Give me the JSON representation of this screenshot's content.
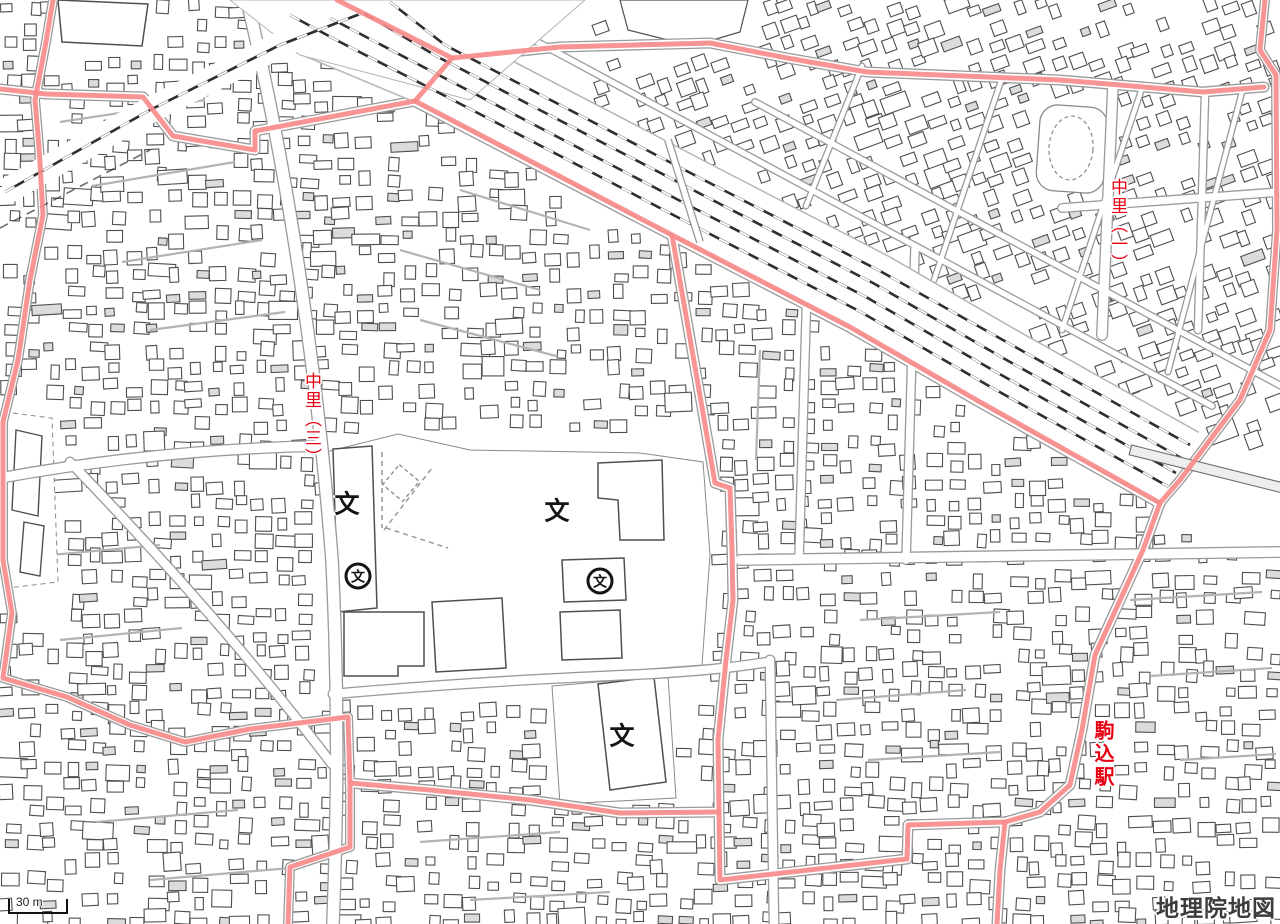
{
  "map": {
    "attribution": "地理院地図",
    "scale_bar": {
      "label": "30 m"
    },
    "place_labels": [
      {
        "id": "nakazato-3-chome",
        "text": "中里（三）",
        "orientation": "vertical",
        "color": "#e60012"
      },
      {
        "id": "nakazato-1-chome",
        "text": "中里（一）",
        "orientation": "vertical",
        "color": "#e60012"
      },
      {
        "id": "komagome-station",
        "text": "駒込駅",
        "orientation": "vertical",
        "color": "#e60012"
      }
    ],
    "symbols": [
      {
        "id": "school-1",
        "type": "elementary-junior-high-school",
        "glyph": "文",
        "circled": false
      },
      {
        "id": "school-2",
        "type": "elementary-junior-high-school",
        "glyph": "文",
        "circled": false
      },
      {
        "id": "school-3",
        "type": "elementary-junior-high-school",
        "glyph": "文",
        "circled": false
      },
      {
        "id": "high-school-1",
        "type": "high-school",
        "glyph": "文",
        "circled": true
      },
      {
        "id": "high-school-2",
        "type": "high-school",
        "glyph": "文",
        "circled": true
      }
    ],
    "colors": {
      "background": "#ffffff",
      "boundary_pink": "#f98b8b",
      "label_red": "#e60012",
      "building_outline": "#4f4f4f",
      "building_fill": "#ffffff",
      "building_fill_alt": "#dcdcdc",
      "road_casing": "#9a9a9a",
      "road_fill": "#ffffff",
      "minor_street": "#b3b3b3",
      "railway": "#2e2e2e",
      "open_area_outline": "#8a8a8a"
    }
  }
}
